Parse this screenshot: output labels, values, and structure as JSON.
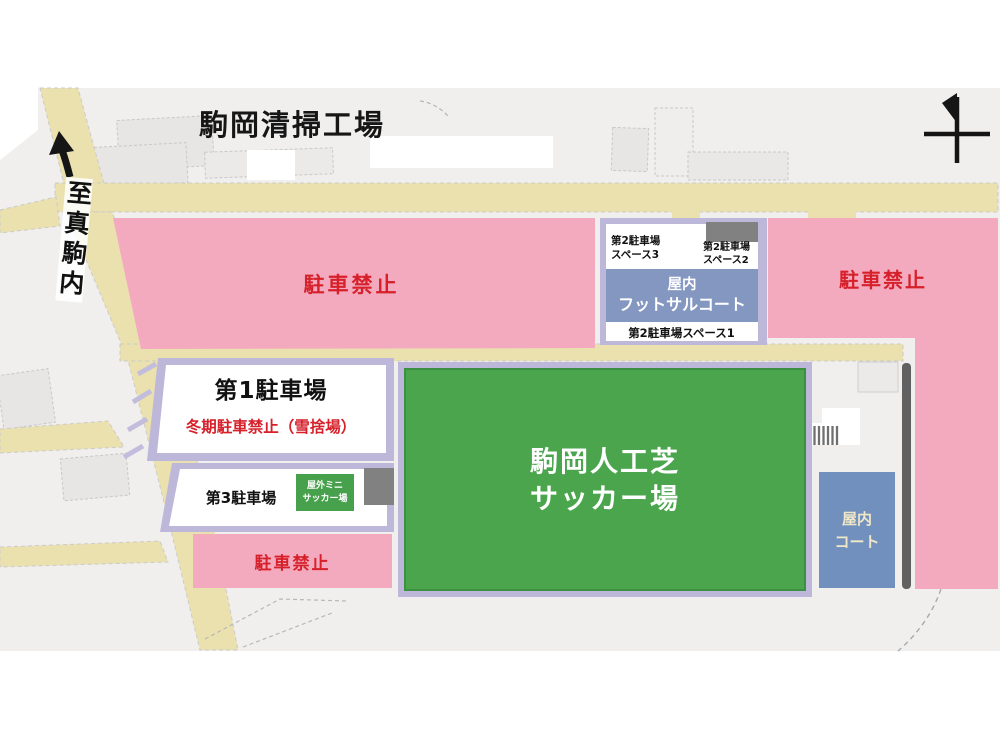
{
  "map": {
    "plant_title": "駒岡清掃工場",
    "direction_sign": {
      "label": "至真駒内"
    },
    "no_parking": {
      "left": "駐車禁止",
      "right": "駐車禁止",
      "bottom": "駐車禁止"
    },
    "parking1": {
      "title": "第1駐車場",
      "winter_note": "冬期駐車禁止（雪捨場）"
    },
    "parking2": {
      "space3_line1": "第2駐車場",
      "space3_line2": "スペース3",
      "space2_line1": "第2駐車場",
      "space2_line2": "スペース2",
      "space1": "第2駐車場スペース1",
      "futsal_line1": "屋内",
      "futsal_line2": "フットサルコート"
    },
    "parking3": {
      "title": "第3駐車場",
      "mini_line1": "屋外ミニ",
      "mini_line2": "サッカー場"
    },
    "main_field": {
      "line1": "駒岡人工芝",
      "line2": "サッカー場"
    },
    "indoor_court": {
      "line1": "屋内",
      "line2": "コート"
    },
    "icons": {
      "north_arrow": "north-arrow-icon",
      "up_arrow": "up-arrow-icon",
      "grating": "grating-icon"
    },
    "colors": {
      "map_background": "#f0efed",
      "road": "#eae1ae",
      "no_parking_pink": "#f4aabe",
      "warning_red": "#d6202a",
      "zone_border_lavender": "#bdb7da",
      "field_green": "#4aa54d",
      "mini_field_green": "#47a04b",
      "futsal_blue": "#8497c0",
      "indoor_court_blue": "#7190bd",
      "building_gray": "#818181",
      "fence_gray": "#616161"
    }
  }
}
